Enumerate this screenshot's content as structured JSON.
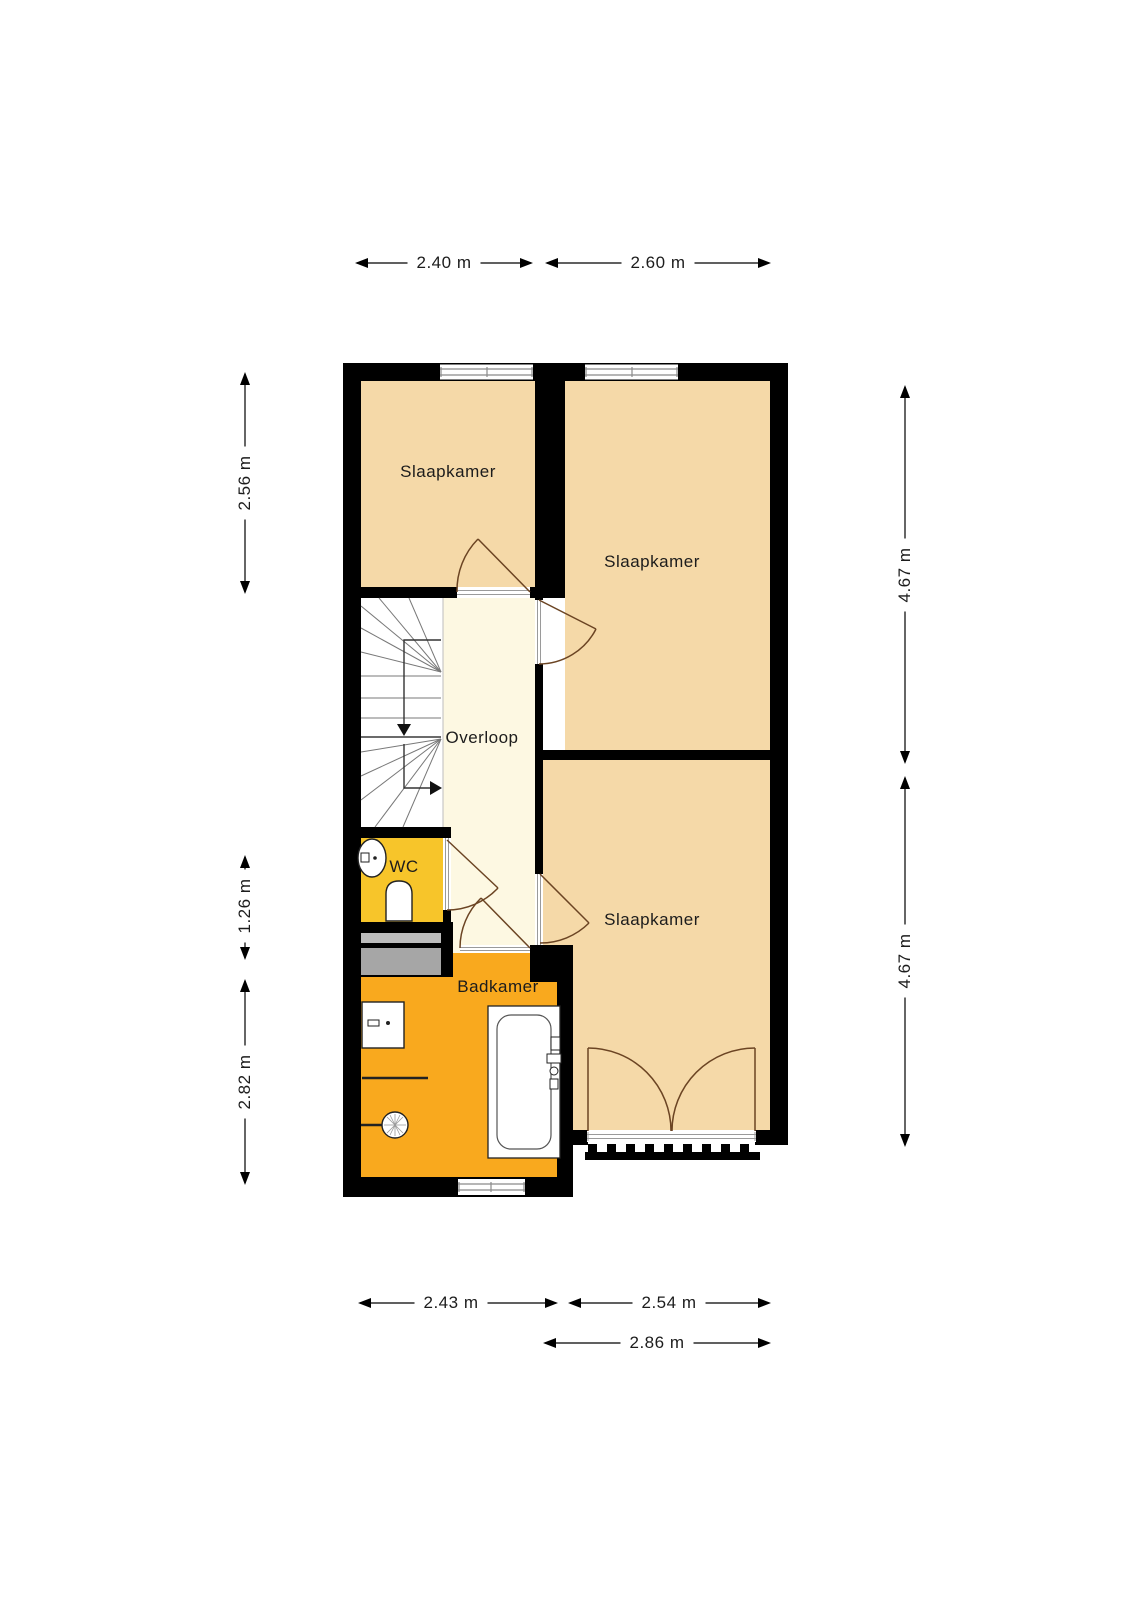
{
  "rooms": {
    "slaapkamer_top_left": {
      "label": "Slaapkamer"
    },
    "slaapkamer_top_right": {
      "label": "Slaapkamer"
    },
    "slaapkamer_bottom": {
      "label": "Slaapkamer"
    },
    "overloop": {
      "label": "Overloop"
    },
    "wc": {
      "label": "WC"
    },
    "badkamer": {
      "label": "Badkamer"
    }
  },
  "dimensions": {
    "top_left": {
      "label": "2.40 m"
    },
    "top_right": {
      "label": "2.60 m"
    },
    "left_top": {
      "label": "2.56 m"
    },
    "left_middle": {
      "label": "1.26 m"
    },
    "left_bottom": {
      "label": "2.82 m"
    },
    "right_top": {
      "label": "4.67 m"
    },
    "right_bottom": {
      "label": "4.67 m"
    },
    "bottom_left": {
      "label": "2.43 m"
    },
    "bottom_right": {
      "label": "2.54 m"
    },
    "bottom_overall": {
      "label": "2.86 m"
    }
  },
  "colors": {
    "wall": "#000000",
    "bedroom_floor": "#f5d9a8",
    "hallway_floor": "#fdf8e2",
    "wc_floor": "#f7c52a",
    "bathroom_floor": "#f9a91e",
    "stairs_floor": "#ffffff",
    "door_arc": "#6b4423",
    "shaft_gray_light": "#bcbcbc",
    "shaft_gray_dark": "#a6a6a6",
    "dimension_line": "#000000"
  }
}
